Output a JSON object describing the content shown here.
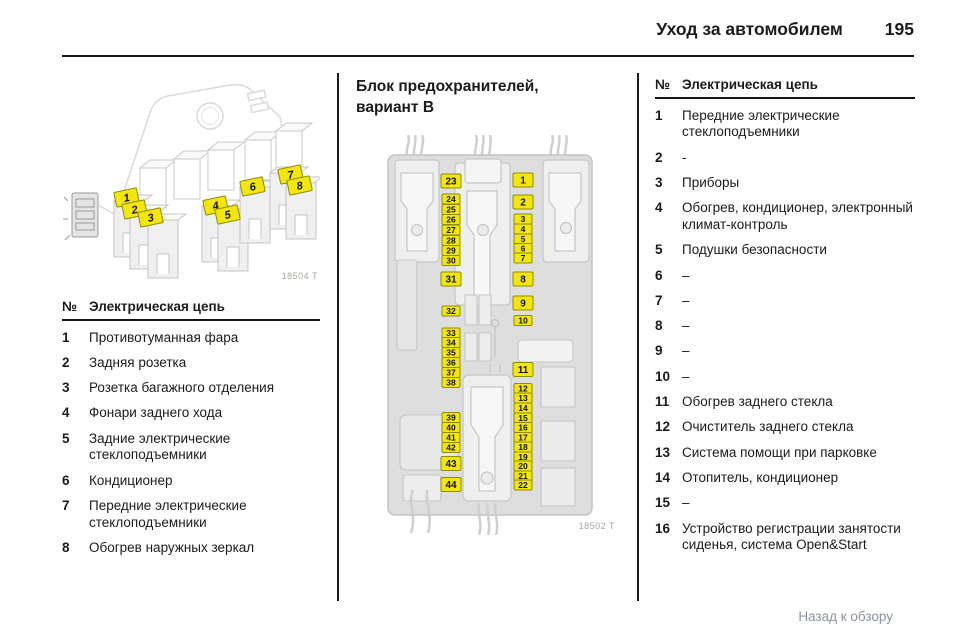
{
  "header": {
    "title": "Уход за автомобилем",
    "page_number": "195"
  },
  "left_figure": {
    "caption": "18504 T",
    "tags": [
      {
        "n": "1",
        "x": 53,
        "y": 117
      },
      {
        "n": "2",
        "x": 61,
        "y": 129
      },
      {
        "n": "3",
        "x": 77,
        "y": 137
      },
      {
        "n": "4",
        "x": 142,
        "y": 125
      },
      {
        "n": "5",
        "x": 154,
        "y": 134
      },
      {
        "n": "6",
        "x": 179,
        "y": 106
      },
      {
        "n": "7",
        "x": 217,
        "y": 94
      },
      {
        "n": "8",
        "x": 226,
        "y": 105
      }
    ]
  },
  "left_table": {
    "header_no": "№",
    "header_circuit": "Электрическая цепь",
    "rows": [
      {
        "n": "1",
        "text": "Противотуманная фара"
      },
      {
        "n": "2",
        "text": "Задняя розетка"
      },
      {
        "n": "3",
        "text": "Розетка багажного отделения"
      },
      {
        "n": "4",
        "text": "Фонари заднего хода"
      },
      {
        "n": "5",
        "text": "Задние электрические стеклоподъемники"
      },
      {
        "n": "6",
        "text": "Кондиционер"
      },
      {
        "n": "7",
        "text": "Передние электрические стеклоподъемники"
      },
      {
        "n": "8",
        "text": "Обогрев наружных зеркал"
      }
    ]
  },
  "middle": {
    "title_line1": "Блок предохранителей,",
    "title_line2": "вариант B",
    "figure_caption": "18502 T",
    "fuse_labels": [
      {
        "n": "23",
        "cx": 68,
        "cy": 46,
        "big": true
      },
      {
        "n": "24",
        "cx": 68,
        "cy": 64
      },
      {
        "n": "25",
        "cx": 68,
        "cy": 74.5
      },
      {
        "n": "26",
        "cx": 68,
        "cy": 84.5
      },
      {
        "n": "27",
        "cx": 68,
        "cy": 95
      },
      {
        "n": "28",
        "cx": 68,
        "cy": 105.5
      },
      {
        "n": "29",
        "cx": 68,
        "cy": 115.5
      },
      {
        "n": "30",
        "cx": 68,
        "cy": 125.5
      },
      {
        "n": "31",
        "cx": 68,
        "cy": 144,
        "big": true
      },
      {
        "n": "32",
        "cx": 68,
        "cy": 176
      },
      {
        "n": "33",
        "cx": 68,
        "cy": 198
      },
      {
        "n": "34",
        "cx": 68,
        "cy": 207.5
      },
      {
        "n": "35",
        "cx": 68,
        "cy": 217.5
      },
      {
        "n": "36",
        "cx": 68,
        "cy": 227.5
      },
      {
        "n": "37",
        "cx": 68,
        "cy": 237.5
      },
      {
        "n": "38",
        "cx": 68,
        "cy": 247.5
      },
      {
        "n": "39",
        "cx": 68,
        "cy": 282.5
      },
      {
        "n": "40",
        "cx": 68,
        "cy": 292.5
      },
      {
        "n": "41",
        "cx": 68,
        "cy": 302.5
      },
      {
        "n": "42",
        "cx": 68,
        "cy": 312.5
      },
      {
        "n": "43",
        "cx": 68,
        "cy": 328.5,
        "big": true
      },
      {
        "n": "44",
        "cx": 68,
        "cy": 349.5,
        "big": true
      },
      {
        "n": "1",
        "cx": 140,
        "cy": 45,
        "big": true
      },
      {
        "n": "2",
        "cx": 140,
        "cy": 67,
        "big": true
      },
      {
        "n": "3",
        "cx": 140,
        "cy": 84
      },
      {
        "n": "4",
        "cx": 140,
        "cy": 94
      },
      {
        "n": "5",
        "cx": 140,
        "cy": 104
      },
      {
        "n": "6",
        "cx": 140,
        "cy": 113.5
      },
      {
        "n": "7",
        "cx": 140,
        "cy": 123
      },
      {
        "n": "8",
        "cx": 140,
        "cy": 144,
        "big": true
      },
      {
        "n": "9",
        "cx": 140,
        "cy": 168,
        "big": true
      },
      {
        "n": "10",
        "cx": 140,
        "cy": 185.5
      },
      {
        "n": "11",
        "cx": 140,
        "cy": 234.5,
        "big": true
      },
      {
        "n": "12",
        "cx": 140,
        "cy": 253.5
      },
      {
        "n": "13",
        "cx": 140,
        "cy": 263
      },
      {
        "n": "14",
        "cx": 140,
        "cy": 273
      },
      {
        "n": "15",
        "cx": 140,
        "cy": 283
      },
      {
        "n": "16",
        "cx": 140,
        "cy": 292.5
      },
      {
        "n": "17",
        "cx": 140,
        "cy": 302.5
      },
      {
        "n": "18",
        "cx": 140,
        "cy": 312
      },
      {
        "n": "19",
        "cx": 140,
        "cy": 322
      },
      {
        "n": "20",
        "cx": 140,
        "cy": 331
      },
      {
        "n": "21",
        "cx": 140,
        "cy": 341
      },
      {
        "n": "22",
        "cx": 140,
        "cy": 350
      }
    ]
  },
  "right_table": {
    "header_no": "№",
    "header_circuit": "Электрическая цепь",
    "rows": [
      {
        "n": "1",
        "text": "Передние электрические стеклоподъемники"
      },
      {
        "n": "2",
        "text": "-"
      },
      {
        "n": "3",
        "text": "Приборы"
      },
      {
        "n": "4",
        "text": "Обогрев, кондиционер, электронный климат-контроль"
      },
      {
        "n": "5",
        "text": "Подушки безопасности"
      },
      {
        "n": "6",
        "text": "–"
      },
      {
        "n": "7",
        "text": "–"
      },
      {
        "n": "8",
        "text": "–"
      },
      {
        "n": "9",
        "text": "–"
      },
      {
        "n": "10",
        "text": "–"
      },
      {
        "n": "11",
        "text": "Обогрев заднего стекла"
      },
      {
        "n": "12",
        "text": "Очиститель заднего стекла"
      },
      {
        "n": "13",
        "text": "Система помощи при парковке"
      },
      {
        "n": "14",
        "text": "Отопитель, кондиционер"
      },
      {
        "n": "15",
        "text": "–"
      },
      {
        "n": "16",
        "text": "Устройство регистрации занятости сиденья, система Open&Start"
      }
    ]
  },
  "footer": {
    "back_link": "Назад к обзору"
  },
  "colors": {
    "label_yellow": "#f2e60b",
    "label_border": "#8d8d00",
    "caption_gray": "#aaa69e",
    "link_gray": "#8d939d"
  }
}
